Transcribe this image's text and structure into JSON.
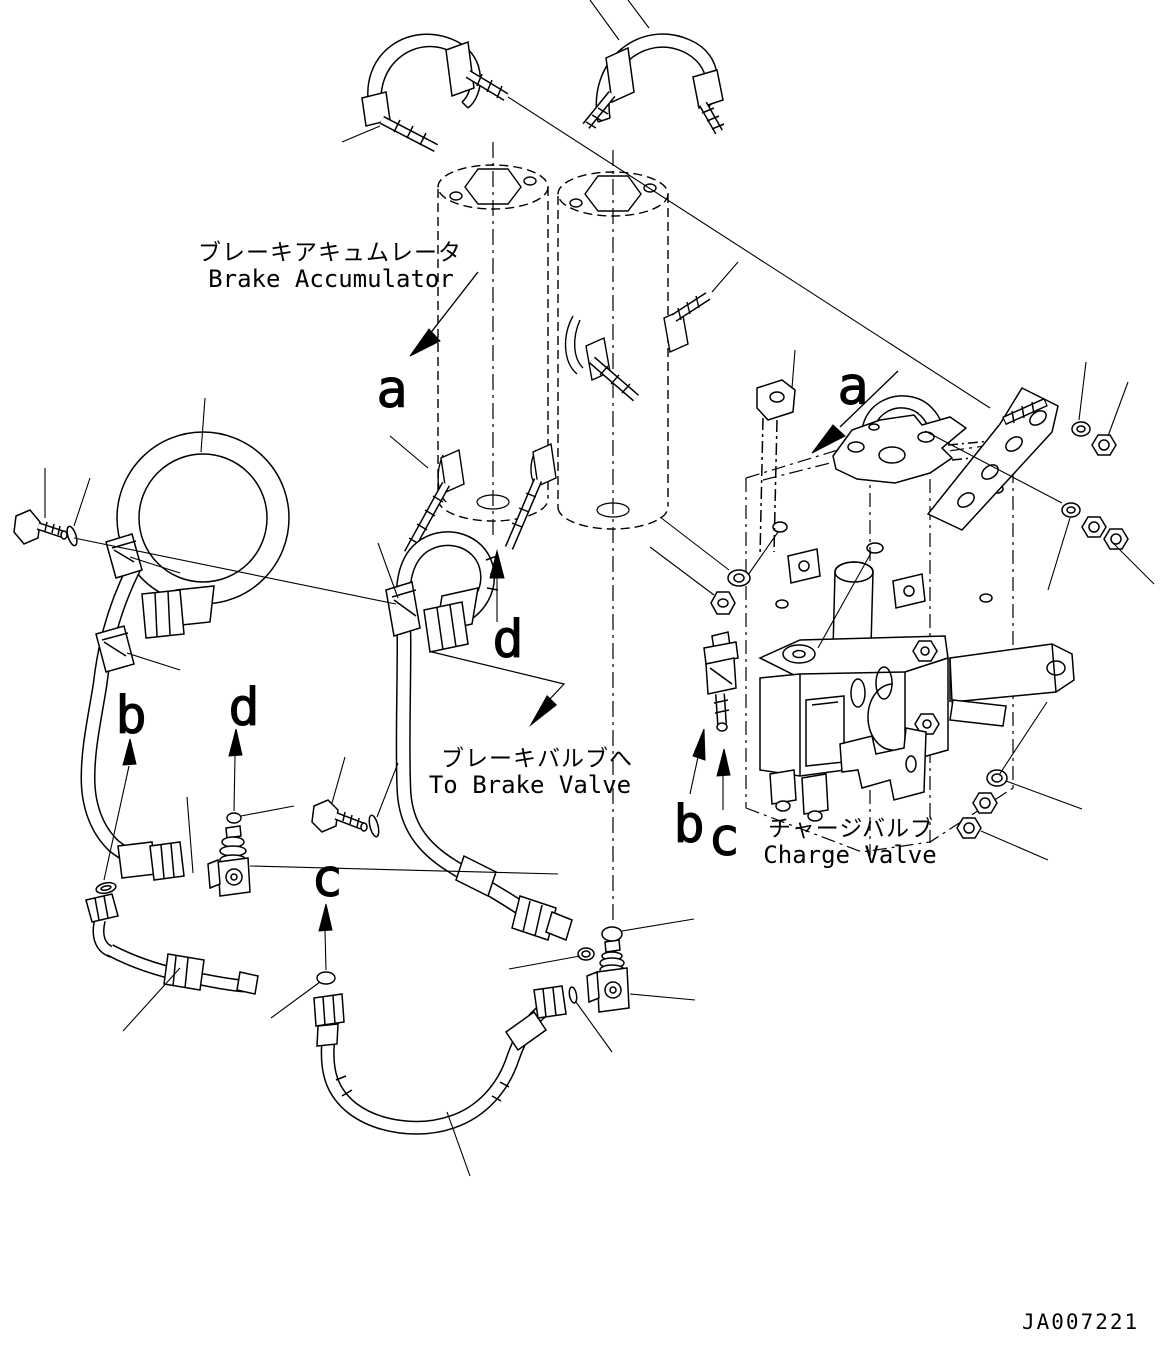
{
  "figure": {
    "number": "JA007221"
  },
  "colors": {
    "ink": "#000000",
    "background": "#ffffff"
  },
  "labels": {
    "brake_accumulator": {
      "jp": "ブレーキアキュムレータ",
      "en": "Brake Accumulator"
    },
    "to_brake_valve": {
      "jp": "ブレーキバルブへ",
      "en": "To Brake Valve"
    },
    "charge_valve": {
      "jp": "チャージバルブ",
      "en": "Charge Valve"
    }
  },
  "view_letters": {
    "a1": "a",
    "a2": "a",
    "b1": "b",
    "b2": "b",
    "c1": "c",
    "c2": "c",
    "d1": "d",
    "d2": "d"
  }
}
